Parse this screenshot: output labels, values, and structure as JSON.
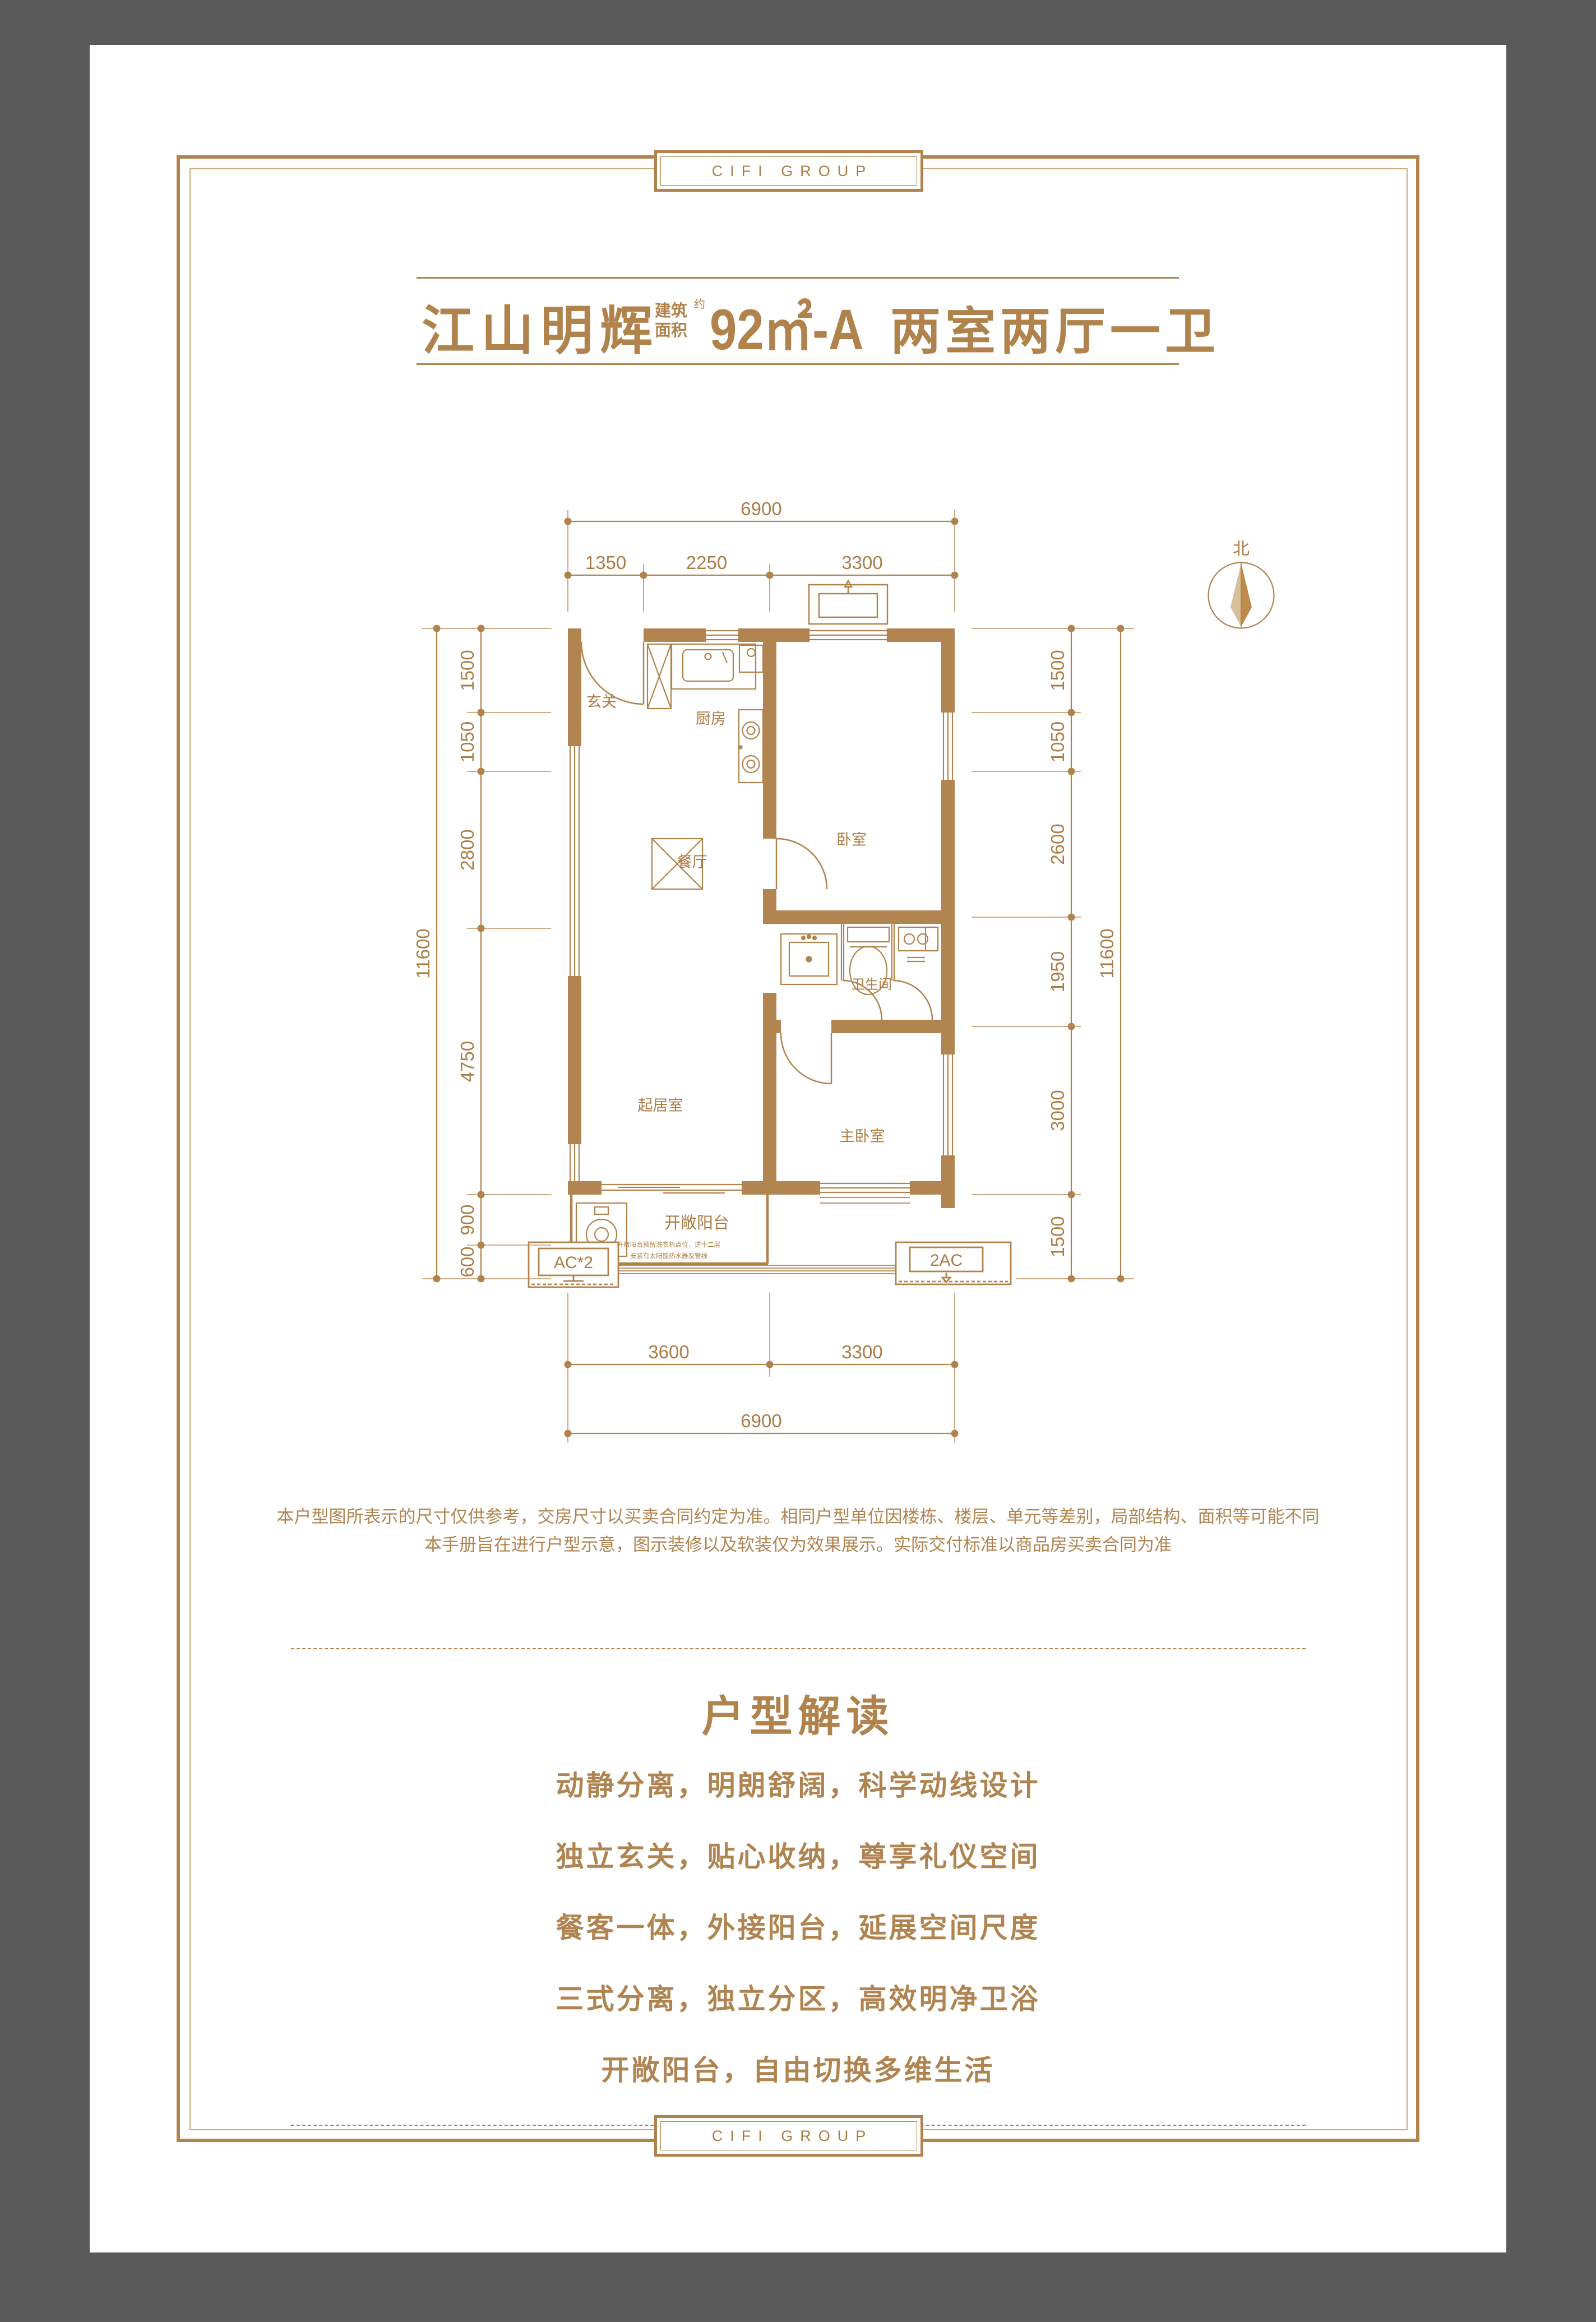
{
  "brand": {
    "name": "CIFI GROUP"
  },
  "header": {
    "project": "江山明辉",
    "area_label_line1": "建筑",
    "area_label_line2": "面积",
    "area_approx": "约",
    "area_value": "92㎡-A",
    "layout_type": "两室两厅一卫"
  },
  "plan": {
    "north_label": "北",
    "rooms": {
      "entry": "玄关",
      "kitchen": "厨房",
      "dining": "餐厅",
      "bedroom": "卧室",
      "bath": "卫生间",
      "living": "起居室",
      "master": "主卧室",
      "balcony": "开敞阳台"
    },
    "balcony_note_line1": "开敞阳台预留洗衣机点位，逆十二层",
    "balcony_note_line2": "安装有太阳能热水器及管线",
    "ac_left_label": "AC*2",
    "ac_right_label": "2AC",
    "dims": {
      "top_total": "6900",
      "top": [
        "1350",
        "2250",
        "3300"
      ],
      "bottom": [
        "3600",
        "3300"
      ],
      "bottom_total": "6900",
      "left": [
        "1500",
        "1050",
        "2800",
        "4750",
        "900",
        "600"
      ],
      "left_total": "11600",
      "right": [
        "1500",
        "1050",
        "2600",
        "1950",
        "3000",
        "1500"
      ],
      "right_total": "11600"
    }
  },
  "disclaimer": {
    "line1": "本户型图所表示的尺寸仅供参考，交房尺寸以买卖合同约定为准。相同户型单位因楼栋、楼层、单元等差别，局部结构、面积等可能不同",
    "line2": "本手册旨在进行户型示意，图示装修以及软装仅为效果展示。实际交付标准以商品房买卖合同为准"
  },
  "interpretation": {
    "title": "户型解读",
    "bullets": [
      "动静分离，明朗舒阔，科学动线设计",
      "独立玄关，贴心收纳，尊享礼仪空间",
      "餐客一体，外接阳台，延展空间尺度",
      "三式分离，独立分区，高效明净卫浴",
      "开敞阳台，自由切换多维生活"
    ]
  },
  "colors": {
    "gold": "#b0824c",
    "gold_light": "#cdab7d",
    "wall_fill": "#b28450",
    "compass_light": "#d6c09c",
    "page": "#ffffff",
    "frame": "#5a5a5a"
  }
}
